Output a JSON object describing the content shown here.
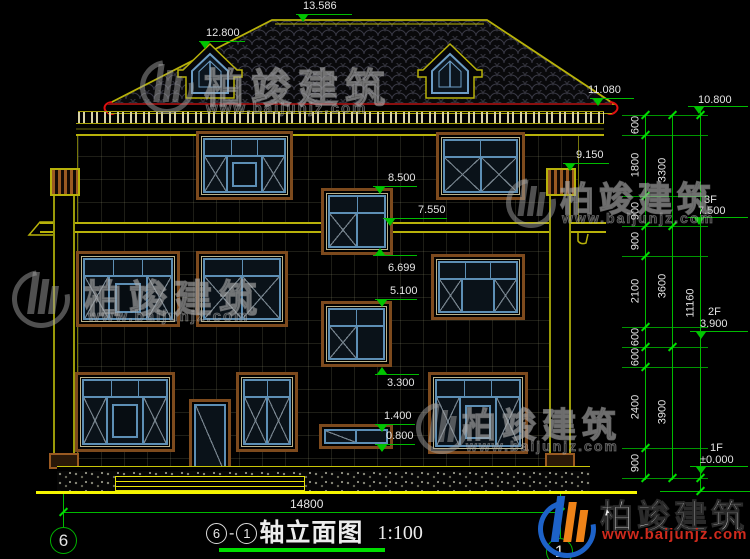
{
  "watermark": {
    "name": "柏竣建筑",
    "url": "www.baijunjz.com"
  },
  "title": {
    "axis_left": "6",
    "sep": "-",
    "axis_right": "1",
    "text": "轴立面图",
    "scale": "1:100"
  },
  "bottom": {
    "overall_width": "14800",
    "axis_left": "6",
    "axis_right": "1"
  },
  "marks": {
    "ridge": "13.586",
    "dormer_top": "12.800",
    "eave": "11.080",
    "pilaster_top": "9.150",
    "stair_win3_top": "8.500",
    "slab_3f": "7.550",
    "stair_win3_bottom": "6.699",
    "stair_win2_top": "5.100",
    "win1_top": "3.300",
    "stair_win1_top": "1.400",
    "stair_win1_bottom": "0.800"
  },
  "right_dims": {
    "chain_small": [
      "600",
      "1800",
      "900",
      "900",
      "2100",
      "600",
      "600",
      "2400",
      "900"
    ],
    "chain_mid": [
      "3300",
      "3600",
      "3900"
    ],
    "total": "11160",
    "levels": [
      {
        "label": "",
        "value": "10.800"
      },
      {
        "label": "3F",
        "value": "7.500"
      },
      {
        "label": "2F",
        "value": "3.900"
      },
      {
        "label": "1F",
        "value": "±0.000"
      }
    ]
  }
}
